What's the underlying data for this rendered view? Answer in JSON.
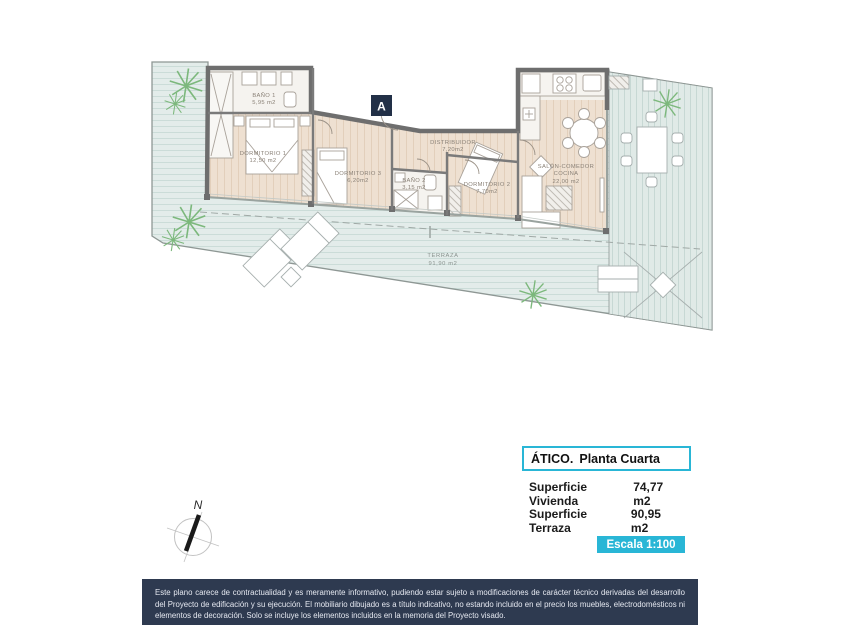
{
  "colors": {
    "accent": "#29b6d6",
    "disclaimer_bg": "#2e3a50",
    "marker_bg": "#223047",
    "wall": "#6e6e6e",
    "deck_floor": "#e3ecea",
    "wood_floor": "#eee0d1",
    "plant_green": "#7cb87c"
  },
  "plan": {
    "section_marker": "A",
    "compass_label": "N",
    "rooms": [
      {
        "id": "bano1",
        "name": "BAÑO 1",
        "area": "5,95 m2"
      },
      {
        "id": "dormitorio1",
        "name": "DORMITORIO 1",
        "area": "12,50 m2"
      },
      {
        "id": "dormitorio3",
        "name": "DORMITORIO 3",
        "area": "6,20m2"
      },
      {
        "id": "bano2",
        "name": "BAÑO 2",
        "area": "3,15 m2"
      },
      {
        "id": "dormitorio2",
        "name": "DORMITORIO 2",
        "area": "7,70m2"
      },
      {
        "id": "distribuidor",
        "name": "DISTRIBUIDOR",
        "area": "7,20m2"
      },
      {
        "id": "salon",
        "name": "SALÓN-COMEDOR",
        "name2": "COCINA",
        "area": "22,00 m2"
      },
      {
        "id": "terraza",
        "name": "TERRAZA",
        "area": "91,90 m2"
      }
    ]
  },
  "info_panel": {
    "title_prefix": "ÁTICO.",
    "title_text": "Planta Cuarta",
    "rows": [
      {
        "label": "Superficie Vivienda",
        "value": "74,77 m2"
      },
      {
        "label": "Superficie Terraza",
        "value": "90,95 m2"
      }
    ],
    "scale_label": "Escala 1:100"
  },
  "disclaimer": "Este plano carece de contractualidad y es meramente informativo, pudiendo estar sujeto a modificaciones de carácter técnico derivadas del desarrollo del Proyecto de edificación y su ejecución. El mobiliario dibujado es a título indicativo, no estando incluido en el precio los muebles, electrodomésticos ni elementos de decoración. Solo se incluye los elementos incluidos en la memoria del Proyecto visado."
}
